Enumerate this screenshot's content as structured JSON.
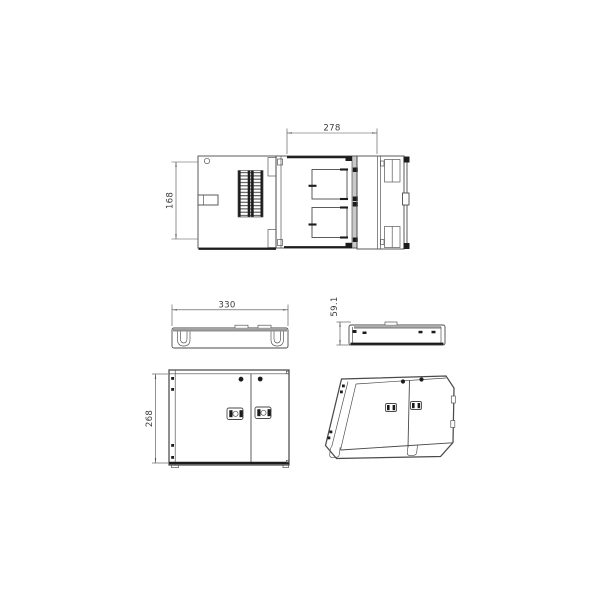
{
  "colors": {
    "background": "#ffffff",
    "line": "#4a4a4a",
    "gray": "#919191",
    "dark": "#1c1c1c",
    "text": "#3d3d3d"
  },
  "dimensions": {
    "top_width": "278",
    "top_depth": "168",
    "base_width": "330",
    "side_height": "59.1",
    "front_height": "268"
  }
}
